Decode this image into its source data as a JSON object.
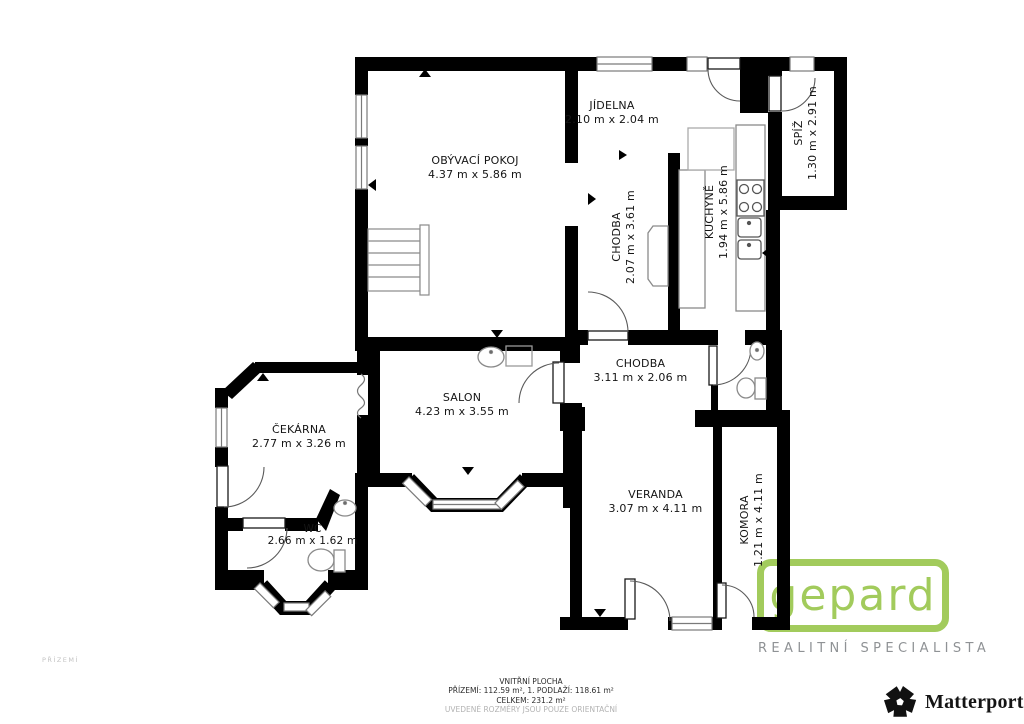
{
  "rooms": [
    {
      "id": "obyvaci-pokoj",
      "name": "OBÝVACÍ POKOJ",
      "dims": "4.37 m x 5.86 m"
    },
    {
      "id": "jidelna",
      "name": "JÍDELNA",
      "dims": "2.10 m x 2.04 m"
    },
    {
      "id": "chodba-horni",
      "name": "CHODBA",
      "dims": "2.07 m x 3.61 m"
    },
    {
      "id": "kuchyne",
      "name": "KUCHYNĚ",
      "dims": "1.94 m x 5.86 m"
    },
    {
      "id": "spiz",
      "name": "SPÍŽ",
      "dims": "1.30 m x 2.91 m"
    },
    {
      "id": "chodba-dolni",
      "name": "CHODBA",
      "dims": "3.11 m x 2.06 m"
    },
    {
      "id": "salon",
      "name": "SALON",
      "dims": "4.23 m x 3.55 m"
    },
    {
      "id": "cekarna",
      "name": "ČEKÁRNA",
      "dims": "2.77 m x 3.26 m"
    },
    {
      "id": "wc",
      "name": "WC",
      "dims": "2.66 m x 1.62 m"
    },
    {
      "id": "veranda",
      "name": "VERANDA",
      "dims": "3.07 m x 4.11 m"
    },
    {
      "id": "komora",
      "name": "KOMORA",
      "dims": "1.21 m x 4.11 m"
    }
  ],
  "floor_label": "PŘÍZEMÍ",
  "footer": {
    "line1": "VNITŘNÍ PLOCHA",
    "line2": "PŘÍZEMÍ: 112.59 m², 1. PODLAŽÍ: 118.61 m²",
    "line3": "CELKEM: 231.2 m²",
    "line4": "UVEDENÉ ROZMĚRY JSOU POUZE ORIENTAČNÍ"
  },
  "branding": {
    "gepard": {
      "wordmark": "gepard",
      "tagline": "REALITNÍ SPECIALISTA",
      "green": "#a2cb5c",
      "gray": "#8f9295"
    },
    "matterport": {
      "wordmark": "Matterport",
      "trademark": "’"
    }
  }
}
